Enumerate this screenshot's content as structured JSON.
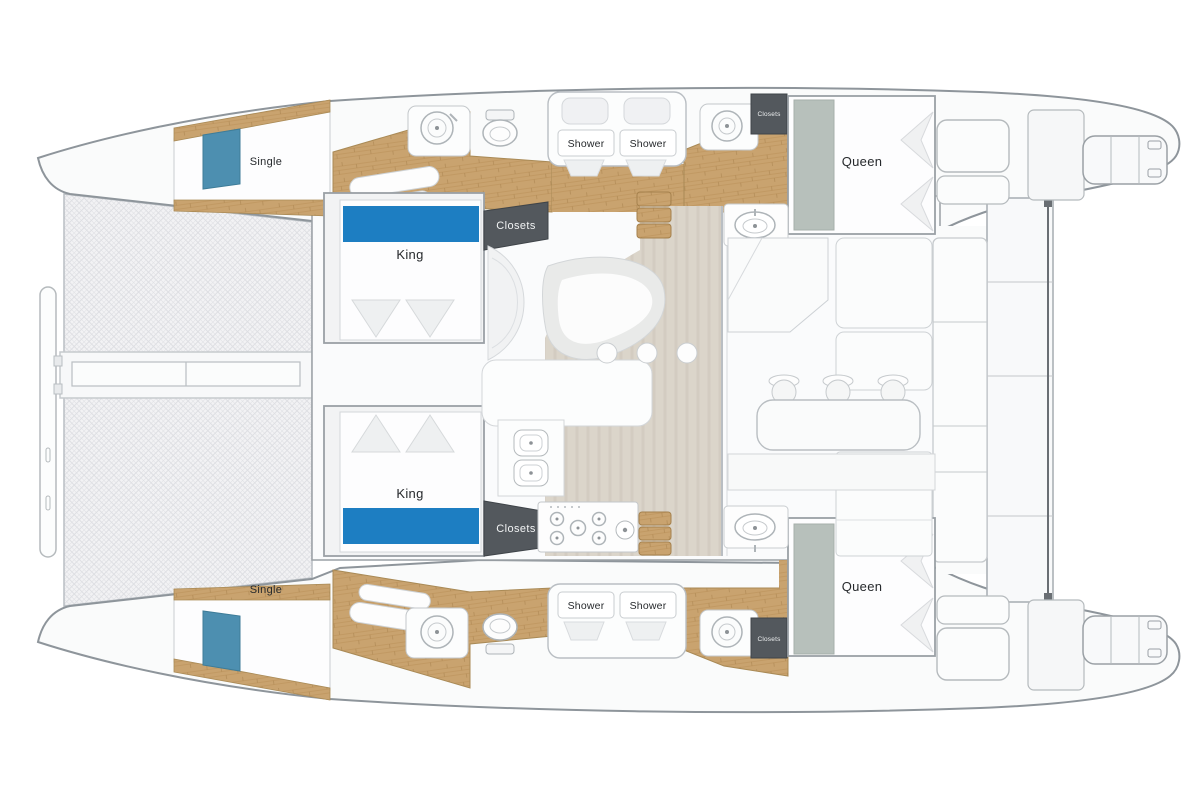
{
  "colors": {
    "king_blue": "#1d7ec2",
    "hatch_blue": "#4d8fb0",
    "queen_band": "#b7c0bb",
    "closet_dark": "#53585d",
    "wood": "#c9a36f",
    "wood_dark": "#b08a55",
    "floor_beige": "#dbd5ca",
    "deck_white": "#fafbfb",
    "outline_gray": "#8e959b",
    "net_gray": "#f2f2f4",
    "label_dark": "#26292c"
  },
  "cabins": {
    "single_top": {
      "label": "Single"
    },
    "single_bottom": {
      "label": "Single"
    },
    "king_top": {
      "label": "King"
    },
    "king_bottom": {
      "label": "King"
    },
    "queen_top": {
      "label": "Queen"
    },
    "queen_bottom": {
      "label": "Queen"
    }
  },
  "facilities": {
    "shower_top_left": {
      "label": "Shower"
    },
    "shower_top_right": {
      "label": "Shower"
    },
    "shower_bottom_left": {
      "label": "Shower"
    },
    "shower_bottom_right": {
      "label": "Shower"
    },
    "closets_salon_top": {
      "label": "Closets"
    },
    "closets_salon_bottom": {
      "label": "Closets"
    },
    "closets_aft_top": {
      "label": "Closets"
    },
    "closets_aft_bottom": {
      "label": "Closets"
    }
  }
}
